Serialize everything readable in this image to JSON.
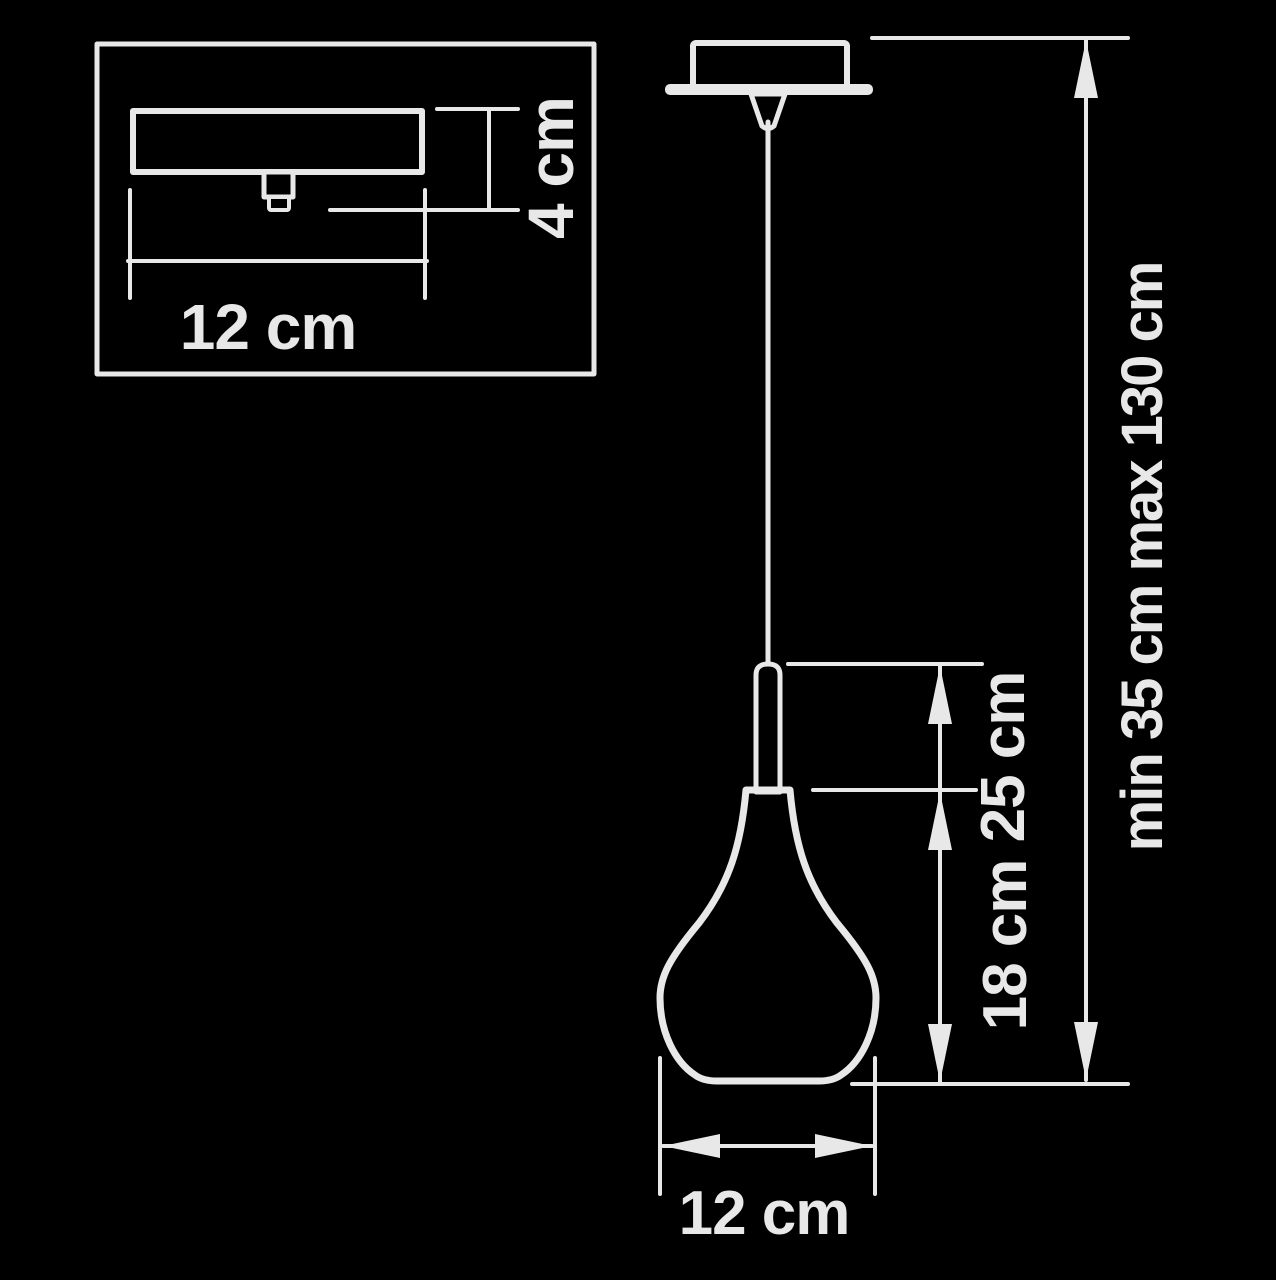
{
  "colors": {
    "background": "#000000",
    "line": "#e8e8e8"
  },
  "diagram_type": "pendant-lamp-dimension-drawing",
  "inset": {
    "canopy_width_label": "12 cm",
    "canopy_height_label": "4 cm"
  },
  "main": {
    "suspension_range_label": "min 35 cm max 130 cm",
    "pendant_height_label": "25 cm",
    "shade_height_label": "18 cm",
    "shade_diameter_label": "12 cm"
  }
}
